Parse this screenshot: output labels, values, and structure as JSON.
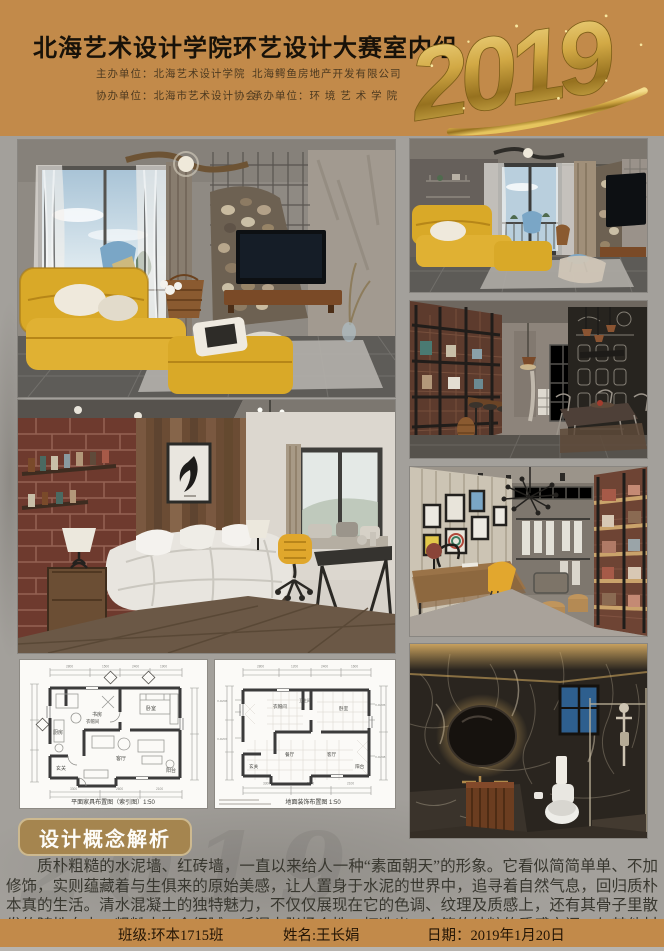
{
  "header": {
    "title": "北海艺术设计学院环艺设计大赛室内组",
    "host": "主办单位：北海艺术设计学院",
    "host_partner": "北海鳄鱼房地产开发有限公司",
    "co_organizer": "协办单位：北海市艺术设计协会",
    "undertaker": "承办单位：环 境 艺 术 学 院",
    "year": "2019"
  },
  "plans": {
    "left_caption": "平面家具布置图（索引图）1:50",
    "right_caption": "地面装饰布置图  1:50",
    "left_rooms": {
      "study": "书房",
      "cloak": "衣帽间",
      "bedroom": "卧室",
      "kitchen": "厨房",
      "entry": "玄关",
      "living": "客厅",
      "balcony": "阳台"
    },
    "right_rooms": {
      "cloak": "衣帽间",
      "bath": "卫生间",
      "bedroom": "卧室",
      "dining": "餐厅",
      "living": "客厅",
      "entry": "玄关",
      "balcony": "阳台"
    }
  },
  "concept": {
    "heading": "设计概念解析",
    "body": "质朴粗糙的水泥墙、红砖墙，一直以来给人一种“素面朝天”的形象。它看似简简单单、不加修饰，实则蕴藏着与生俱来的原始美感，让人置身于水泥的世界中，追寻着自然气息，回归质朴本真的生活。清水混凝土的独特魅力，不仅仅展现在它的色调、纹理及质感上，还有其骨子里散发的随性自由，粗糙中饱含细腻，低调中张扬个性，打造出一个简约纯粹的质感空间，与其他材质相互混搭，碰撞出令人惊艳的现代时尚感。",
    "watermark": "2019"
  },
  "footer": {
    "class_label": "班级:环本1715班",
    "name_label": "姓名:王长娟",
    "date_label": "日期：2019年1月20日"
  },
  "colors": {
    "header_bg": "#c28a4a",
    "panel_bg": "#a3a09b",
    "badge_bg": "#a5854f",
    "gold": "#d9b24a",
    "sofa_yellow": "#d9a928"
  }
}
